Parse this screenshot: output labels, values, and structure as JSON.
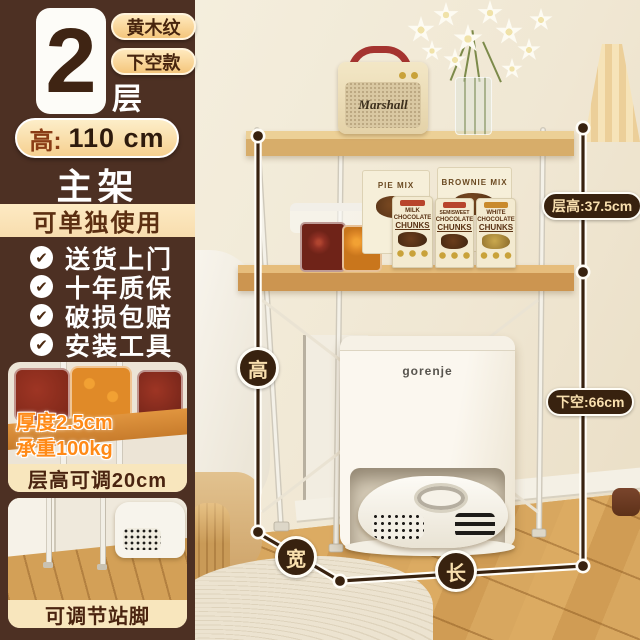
{
  "sidebar": {
    "tier_number": "2",
    "tier_unit": "层",
    "badges": [
      "黄木纹",
      "下空款"
    ],
    "height_label": "高:",
    "height_value": "110 cm",
    "main_frame_label": "主架",
    "standalone_label": "可单独使用",
    "check_icon": "✔",
    "features": [
      "送货上门",
      "十年质保",
      "破损包赔",
      "安装工具"
    ],
    "thumb1": {
      "overlay_thickness": "厚度2.5cm",
      "overlay_capacity": "承重100kg",
      "caption": "层高可调20cm"
    },
    "thumb2": {
      "caption": "可调节站脚"
    }
  },
  "photo": {
    "speaker_brand": "Marshall",
    "station_brand": "gorenje",
    "goods": {
      "box1": "PIE MIX",
      "box2": "BROWNIE MIX",
      "bags": [
        [
          "MILK",
          "CHOCOLATE",
          "CHUNKS"
        ],
        [
          "SEMISWEET",
          "CHOCOLATE",
          "CHUNKS"
        ],
        [
          "WHITE",
          "CHOCOLATE",
          "CHUNKS"
        ]
      ]
    },
    "measurements": {
      "height_label": "高",
      "width_label": "宽",
      "length_label": "长",
      "tier_height": "层高:37.5cm",
      "bottom_clearance": "下空:66cm"
    }
  },
  "colors": {
    "sidebar_bg": "#4d3023",
    "badge_fill": "#f6d090",
    "annotation": "#38220f",
    "overlay_orange": "#ff8a17",
    "wood": "#d8a75f",
    "handle_red": "#a53430"
  }
}
